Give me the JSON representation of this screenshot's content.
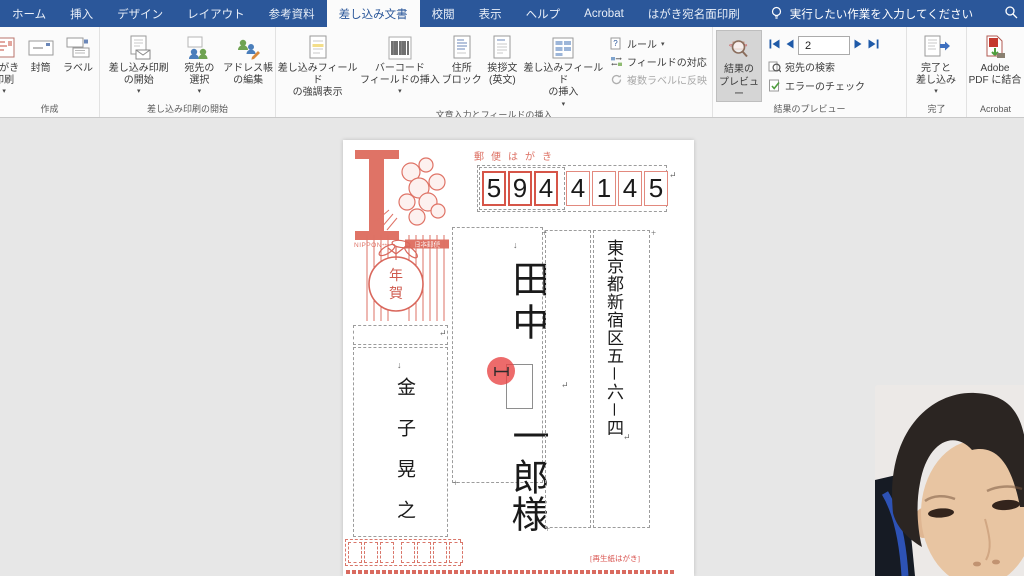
{
  "icons": {
    "dropdown": "▾",
    "down_arrow": "↓",
    "anchor": "↵",
    "handle": "+"
  },
  "titlebar": {
    "tabs": [
      "ホーム",
      "挿入",
      "デザイン",
      "レイアウト",
      "参考資料",
      "差し込み文書",
      "校閲",
      "表示",
      "ヘルプ",
      "Acrobat",
      "はがき宛名面印刷"
    ],
    "tell_me": "実行したい作業を入力してください"
  },
  "ribbon": {
    "create": {
      "group": "作成",
      "hagaki": "はがき\n印刷",
      "envelope": "封筒",
      "labels": "ラベル"
    },
    "start": {
      "group": "差し込み印刷の開始",
      "start_merge": "差し込み印刷\nの開始",
      "select": "宛先の\n選択",
      "edit": "アドレス帳\nの編集"
    },
    "fields": {
      "group": "文章入力とフィールドの挿入",
      "highlight": "差し込みフィールド\nの強調表示",
      "barcode": "バーコード\nフィールドの挿入",
      "address_block": "住所\nブロック",
      "greeting": "挨拶文\n(英文)",
      "insert": "差し込みフィールド\nの挿入",
      "rules": "ルール",
      "match": "フィールドの対応",
      "multi_label": "複数ラベルに反映"
    },
    "preview": {
      "group": "結果のプレビュー",
      "preview_btn": "結果の\nプレビュー",
      "record": "2",
      "find": "宛先の検索",
      "check": "エラーのチェック"
    },
    "finish": {
      "group": "完了",
      "finish_btn": "完了と\n差し込み"
    },
    "acrobat": {
      "group": "Acrobat",
      "merge_pdf": "Adobe\nPDF に結合"
    }
  },
  "postcard": {
    "header": "郵便はがき",
    "digits": [
      "5",
      "9",
      "4",
      "4",
      "1",
      "4",
      "5"
    ],
    "nippon": "NIPPON",
    "nihon_yubin": "日本郵便",
    "nenga_1": "年",
    "nenga_2": "賀",
    "name_upper": "田中",
    "name_lower": "一郎",
    "honorific": "様",
    "address": "東京都新宿区五－六－四",
    "sender": "金子晃之",
    "recycled": "[再生紙はがき]"
  }
}
